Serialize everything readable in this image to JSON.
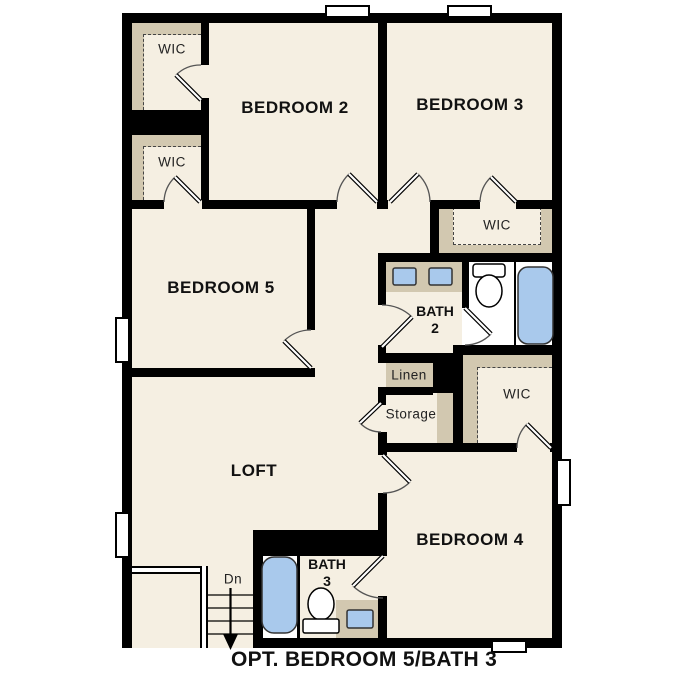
{
  "plan": {
    "caption": "OPT. BEDROOM 5/BATH 3",
    "rooms": {
      "bedroom2": {
        "label": "BEDROOM 2"
      },
      "bedroom3": {
        "label": "BEDROOM 3"
      },
      "bedroom4": {
        "label": "BEDROOM 4"
      },
      "bedroom5": {
        "label": "BEDROOM 5"
      },
      "loft": {
        "label": "LOFT"
      },
      "bath2": {
        "name": "BATH",
        "number": "2"
      },
      "bath3": {
        "name": "BATH",
        "number": "3"
      },
      "wic_bedroom2_upper": {
        "label": "WIC"
      },
      "wic_bedroom2_lower": {
        "label": "WIC"
      },
      "wic_bedroom3": {
        "label": "WIC"
      },
      "wic_bedroom4": {
        "label": "WIC"
      },
      "linen": {
        "label": "Linen"
      },
      "storage": {
        "label": "Storage"
      }
    },
    "stairs": {
      "direction_label": "Dn"
    },
    "fixtures": {
      "bath2": [
        "double-vanity-sinks",
        "toilet",
        "bathtub"
      ],
      "bath3": [
        "bathtub",
        "toilet",
        "vanity-sink"
      ],
      "stairs": [
        "treads",
        "down-arrow",
        "railing"
      ],
      "windows": 6
    },
    "colors": {
      "floor": "#f5efe2",
      "closet": "#d2c8b0",
      "fixture_blue": "#a9c9ec",
      "wall": "#000000",
      "text": "#111111"
    }
  }
}
